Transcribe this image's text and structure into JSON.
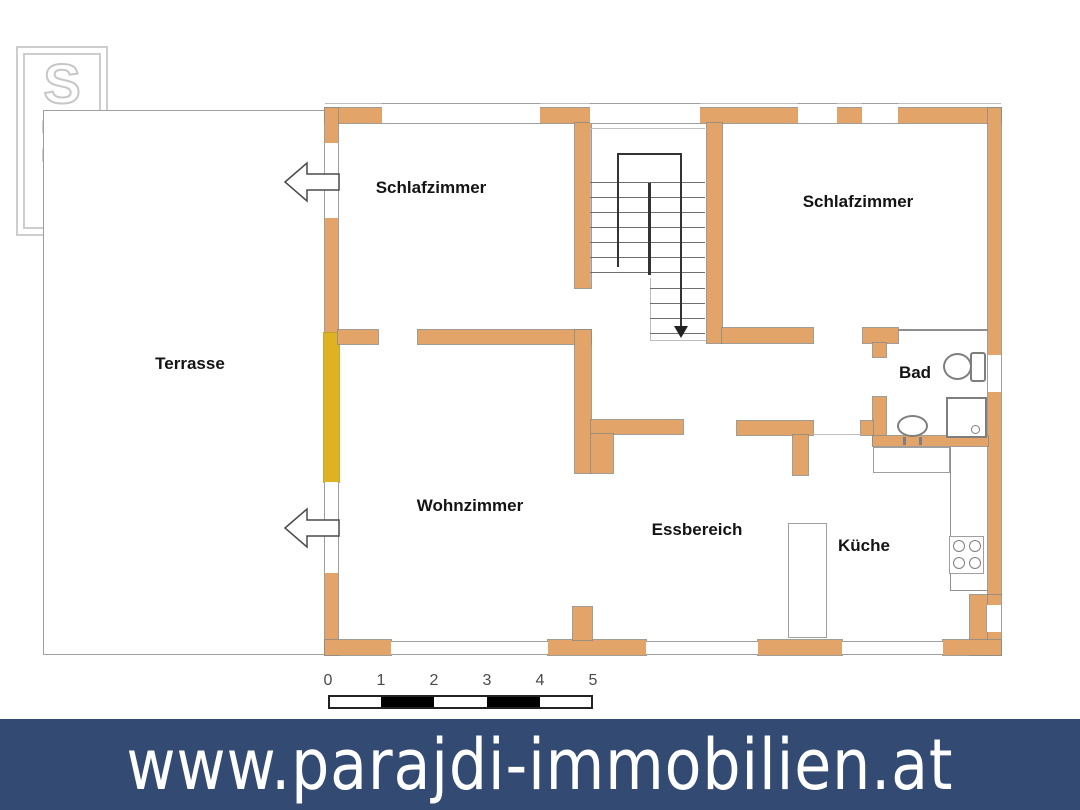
{
  "logo": {
    "letters": [
      "S",
      "M",
      "P"
    ]
  },
  "plan": {
    "labels": {
      "terrasse": "Terrasse",
      "schlafzimmer_left": "Schlafzimmer",
      "schlafzimmer_right": "Schlafzimmer",
      "wohnzimmer": "Wohnzimmer",
      "essbereich": "Essbereich",
      "kueche": "Küche",
      "bad": "Bad"
    }
  },
  "scale_bar": {
    "labels": [
      "0",
      "1",
      "2",
      "3",
      "4",
      "5"
    ]
  },
  "banner": {
    "url": "www.parajdi-immobilien.at"
  },
  "colors": {
    "wall": "#e2a469",
    "highlight": "#dfb224",
    "banner_bg": "#334a72",
    "banner_text": "#ffffff"
  }
}
